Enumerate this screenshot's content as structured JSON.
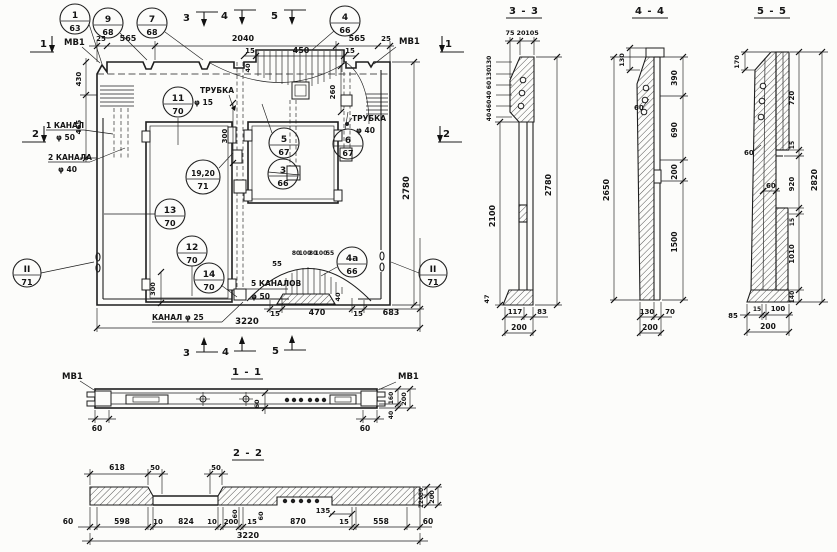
{
  "main": {
    "notes": {
      "mv1": "МВ1",
      "kanal1": "1 КАНАЛ",
      "f50": "φ 50",
      "kanal2": "2 КАНАЛА",
      "f40": "φ 40",
      "trubka": "ТРУБКА",
      "f15": "φ 15",
      "kanal5": "5 КАНАЛОВ",
      "kanal25": "КАНАЛ φ 25"
    },
    "markers": {
      "m1": "1",
      "m2": "2",
      "m3": "3",
      "m4": "4",
      "m5": "5"
    },
    "dims": {
      "d25": "25",
      "d565": "565",
      "d2040": "2040",
      "d15": "15",
      "d450": "450",
      "d40": "40",
      "d430": "430",
      "d465": "465",
      "d300": "300",
      "d260": "260",
      "d2780": "2780",
      "d55": "55",
      "d80": "80",
      "d100": "100",
      "d470": "470",
      "d683": "683",
      "d3220": "3220"
    },
    "callouts": [
      {
        "n": "1",
        "s": "63"
      },
      {
        "n": "9",
        "s": "68"
      },
      {
        "n": "7",
        "s": "68"
      },
      {
        "n": "4",
        "s": "66"
      },
      {
        "n": "11",
        "s": "70"
      },
      {
        "n": "5",
        "s": "67"
      },
      {
        "n": "6",
        "s": "67"
      },
      {
        "n": "3",
        "s": "66"
      },
      {
        "n": "19,20",
        "s": "71"
      },
      {
        "n": "13",
        "s": "70"
      },
      {
        "n": "12",
        "s": "70"
      },
      {
        "n": "14",
        "s": "70"
      },
      {
        "n": "4а",
        "s": "66"
      },
      {
        "n": "II",
        "s": "71"
      },
      {
        "n": "II",
        "s": "71"
      }
    ]
  },
  "s33": {
    "title": "3 - 3",
    "t75": "75",
    "t20": "20",
    "t105": "105",
    "stack": [
      "130",
      "130",
      "60",
      "40",
      "460",
      "40"
    ],
    "h2100": "2100",
    "h2780": "2780",
    "b47": "47",
    "b117": "117",
    "b83": "83",
    "b200": "200"
  },
  "s44": {
    "title": "4 - 4",
    "d130": "130",
    "d60": "60",
    "r390": "390",
    "r690": "690",
    "r200": "200",
    "r1500": "1500",
    "h2650": "2650",
    "b130": "130",
    "b70": "70",
    "b200": "200"
  },
  "s55": {
    "title": "5 - 5",
    "d170": "170",
    "d60": "60",
    "r720": "720",
    "r15": "15",
    "r920": "920",
    "r1010": "1010",
    "r140": "140",
    "h2820": "2820",
    "b85": "85",
    "b15": "15",
    "b100": "100",
    "b200": "200"
  },
  "s11": {
    "title": "1 - 1",
    "mv1": "МВ1",
    "d60": "60",
    "r160": "160",
    "r200": "200",
    "r40": "40"
  },
  "s22": {
    "title": "2 - 2",
    "t618": "618",
    "t50": "50",
    "m60": "60",
    "m135": "135",
    "r80": "80",
    "r120": "120",
    "r200": "200",
    "b": [
      "60",
      "598",
      "10",
      "824",
      "10",
      "200",
      "15",
      "870",
      "15",
      "558",
      "60"
    ],
    "total": "3220"
  }
}
